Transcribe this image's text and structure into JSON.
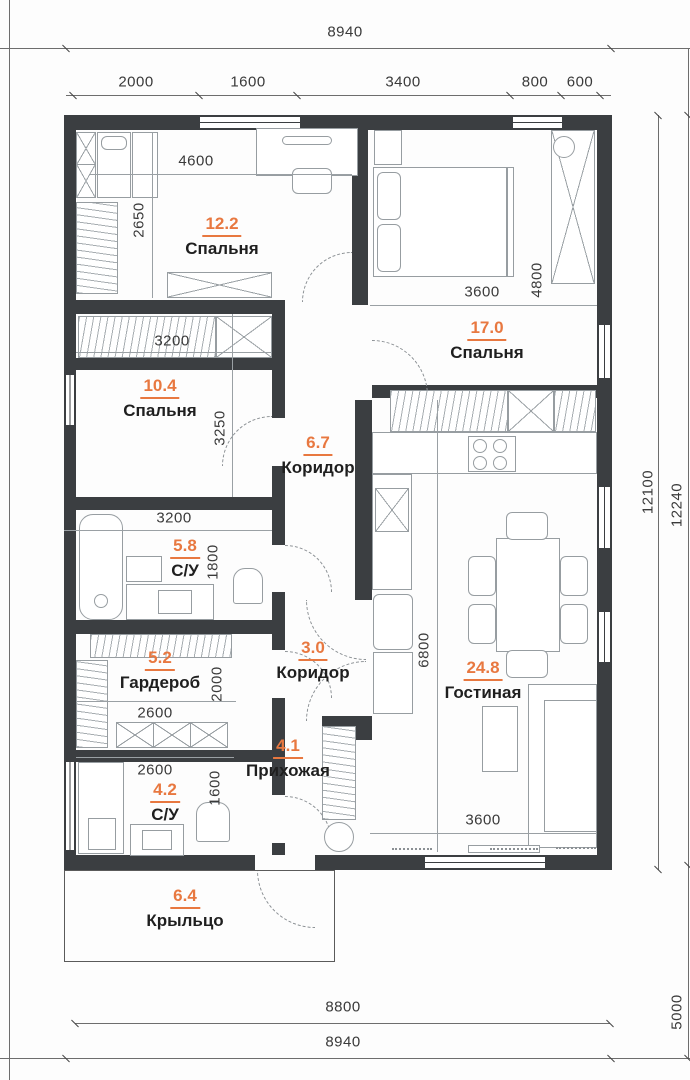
{
  "title": "Floor plan with dimensions",
  "colors": {
    "wall": "#3b3e41",
    "accent": "#e87840",
    "text": "#1f1f1f",
    "dim": "#3a3a3a"
  },
  "rooms": [
    {
      "area": "12.2",
      "name": "Спальня"
    },
    {
      "area": "17.0",
      "name": "Спальня"
    },
    {
      "area": "10.4",
      "name": "Спальня"
    },
    {
      "area": "6.7",
      "name": "Коридор"
    },
    {
      "area": "5.8",
      "name": "С/У"
    },
    {
      "area": "5.2",
      "name": "Гардероб"
    },
    {
      "area": "3.0",
      "name": "Коридор"
    },
    {
      "area": "4.1",
      "name": "Прихожая"
    },
    {
      "area": "4.2",
      "name": "С/У"
    },
    {
      "area": "24.8",
      "name": "Гостиная"
    },
    {
      "area": "6.4",
      "name": "Крыльцо"
    }
  ],
  "dims": {
    "top_total": "8940",
    "chain": [
      "2000",
      "1600",
      "3400",
      "800",
      "600"
    ],
    "bedroom1_w": "4600",
    "bedroom1_h": "2650",
    "closet_w": "3200",
    "bedroom3_h": "3250",
    "bath1_w": "3200",
    "bedroom2_w": "3600",
    "bedroom2_h": "4800",
    "bath1_h": "1800",
    "wardrobe_w": "2600",
    "wardrobe_h": "2000",
    "bath2_w": "2600",
    "bath2_h": "1600",
    "living_h": "6800",
    "living_w": "3600",
    "bottom_inner": "8800",
    "bottom_total": "8940",
    "right_inner": "12100",
    "right_total": "12240",
    "right_side": "5000"
  }
}
